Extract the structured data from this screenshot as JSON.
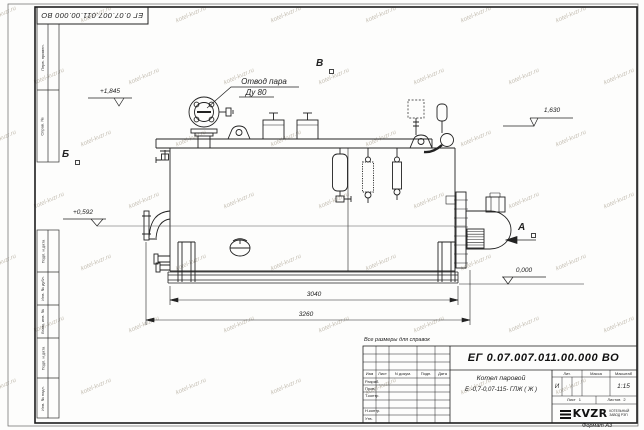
{
  "watermark": {
    "text": "kotel-kvzr.ru"
  },
  "sheet": {
    "top_stamp": "ЕГ 0.07.007.011.00.000  ВО",
    "margin_labels_top": [
      "Перв. примен.",
      "Справ. №"
    ],
    "margin_labels_bottom": [
      "Подп. и дата",
      "Инв. № дубл.",
      "Взам. инв. №",
      "Подп. и дата",
      "Инв. № подл."
    ],
    "reference_note": "Все размеры для справок",
    "format_note": "Формат А3"
  },
  "drawing": {
    "callout_line1": "Отвод пара",
    "callout_line2": "Ду 80",
    "view_b": "Б",
    "view_v": "В",
    "view_a": "А",
    "elev_top": "+1,845",
    "elev_right": "1,630",
    "elev_left": "+0,592",
    "elev_zero": "0,000",
    "dim_inner": "3040",
    "dim_outer": "3260"
  },
  "title_block": {
    "doc_number": "ЕГ 0.07.007.011.00.000  ВО",
    "name_line1": "Котел паровой",
    "name_line2": "Е -0,7-0,07-115- ГЛЖ ( Ж )",
    "col_izm": "Изм",
    "col_list": "Лист",
    "col_docnum": "N докум.",
    "col_podp": "Подп.",
    "col_data": "Дата",
    "row_razrab": "Разраб.",
    "row_prov": "Пров.",
    "row_tkontr": "Т.контр.",
    "row_nkontr": "Н.контр.",
    "row_utv": "Утв.",
    "lit_label": "Лит.",
    "lit_value": "И",
    "massa_label": "Масса",
    "scale_label": "Масштаб",
    "scale_value": "1:15",
    "sheet_label": "Лист",
    "sheet_num": "1",
    "sheets_label": "Листов",
    "sheets_num": "2",
    "logo": "KVZR",
    "logo_sub1": "КОТЕЛЬНЫЙ",
    "logo_sub2": "ЗАВОД РЭП"
  }
}
